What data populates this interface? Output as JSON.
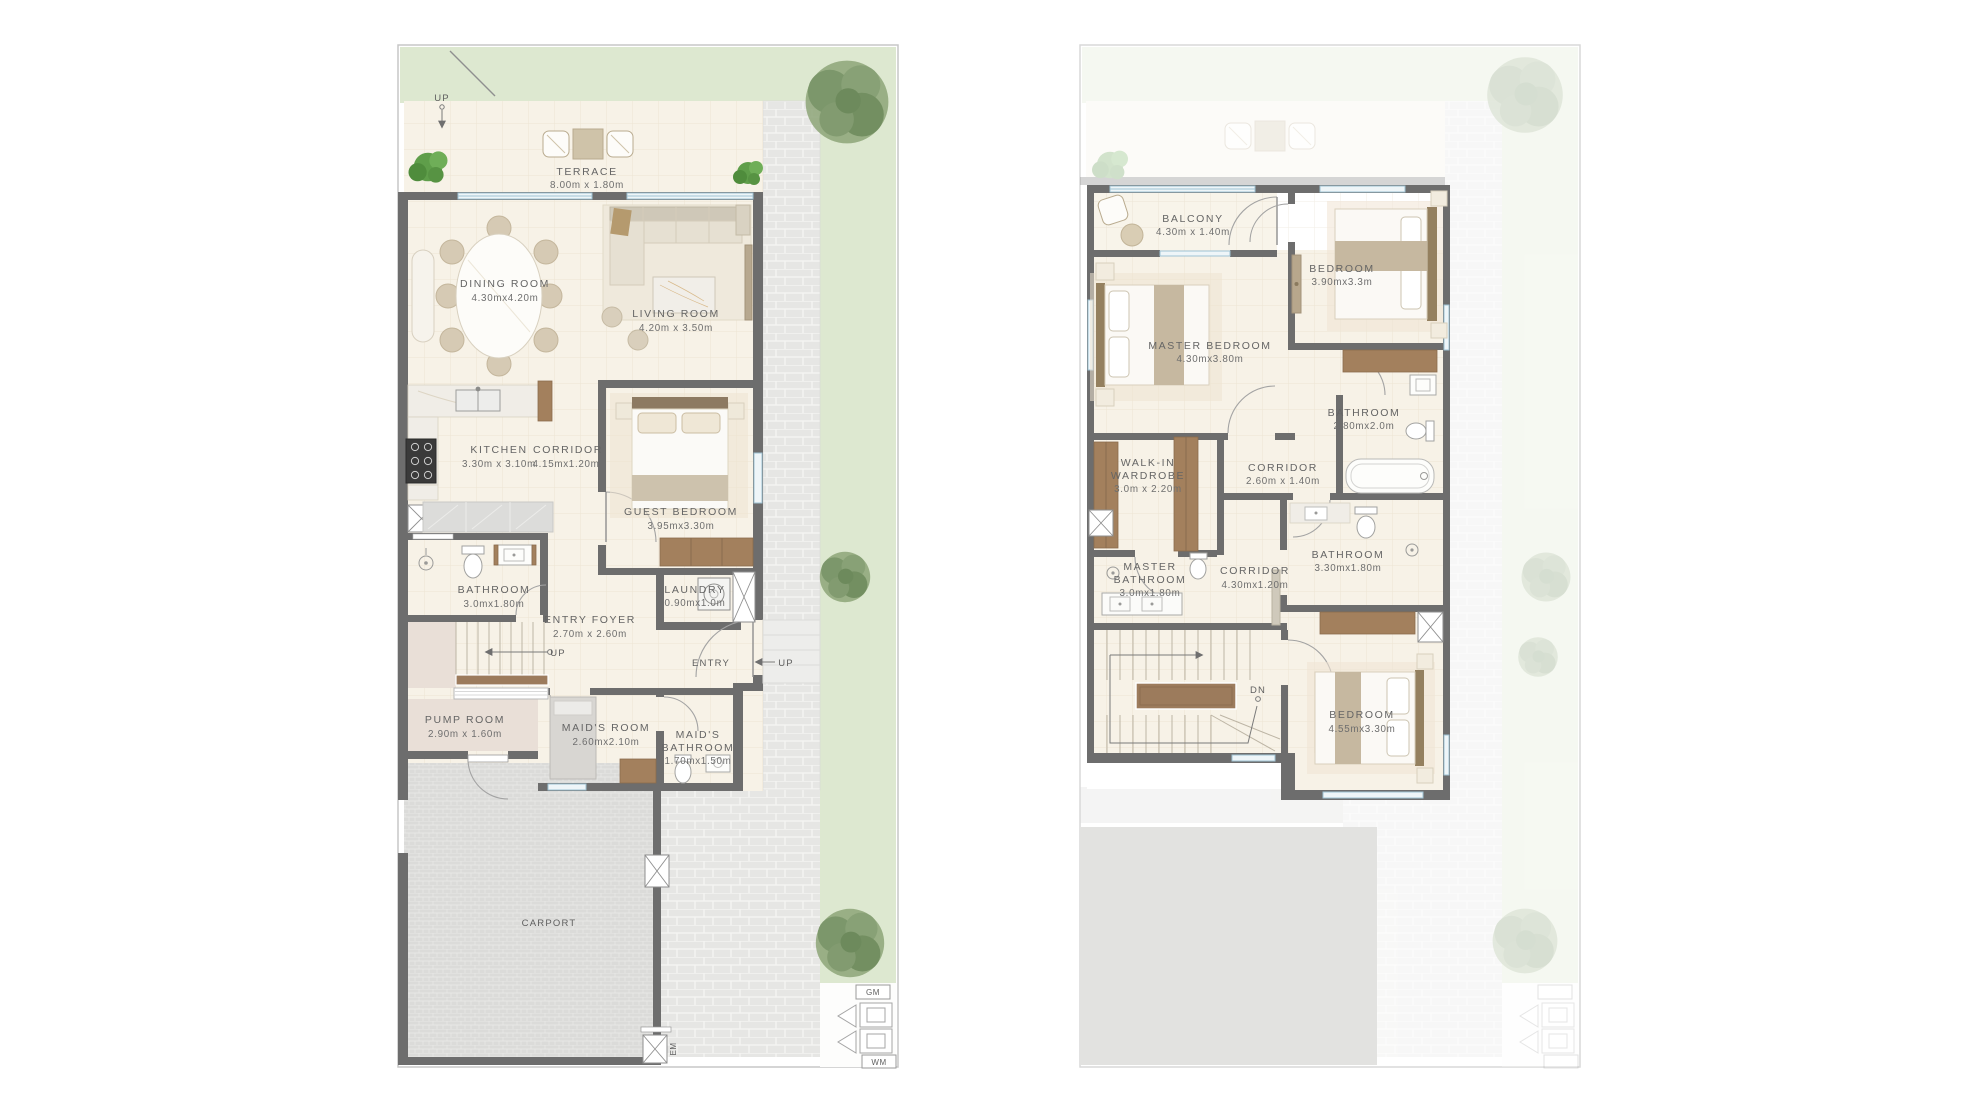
{
  "document": {
    "type": "residential floor plans",
    "views": [
      "ground floor",
      "first floor"
    ]
  },
  "ground_floor": {
    "rooms": [
      {
        "name": "TERRACE",
        "dims": "8.00m x 1.80m"
      },
      {
        "name": "DINING ROOM",
        "dims": "4.30mx4.20m"
      },
      {
        "name": "LIVING ROOM",
        "dims": "4.20m x 3.50m"
      },
      {
        "name": "KITCHEN",
        "dims": "3.30m x 3.10m"
      },
      {
        "name": "CORRIDOR",
        "dims": "4.15mx1.20m"
      },
      {
        "name": "GUEST BEDROOM",
        "dims": "3.95mx3.30m"
      },
      {
        "name": "BATHROOM",
        "dims": "3.0mx1.80m"
      },
      {
        "name": "LAUNDRY",
        "dims": "0.90mx1.0m"
      },
      {
        "name": "ENTRY FOYER",
        "dims": "2.70m x 2.60m"
      },
      {
        "name": "PUMP ROOM",
        "dims": "2.90m x 1.60m"
      },
      {
        "name": "MAID'S ROOM",
        "dims": "2.60mx2.10m"
      },
      {
        "name": "MAID'S",
        "name2": "BATHROOM",
        "dims": "1.70mx1.50m"
      }
    ],
    "annotations": {
      "up_garden": "UP",
      "up_stairs": "UP",
      "entry": "ENTRY",
      "up_entry": "UP",
      "carport": "CARPORT",
      "em": "EM",
      "gm": "GM",
      "wm": "WM"
    }
  },
  "first_floor": {
    "rooms": [
      {
        "name": "BALCONY",
        "dims": "4.30m x 1.40m"
      },
      {
        "name": "MASTER BEDROOM",
        "dims": "4.30mx3.80m"
      },
      {
        "name": "BEDROOM",
        "dims": "3.90mx3.3m"
      },
      {
        "name": "BATHROOM",
        "dims": "2.80mx2.0m"
      },
      {
        "name": "WALK-IN",
        "name2": "WARDROBE",
        "dims": "3.0m x 2.20m"
      },
      {
        "name": "CORRIDOR",
        "dims": "2.60m x 1.40m"
      },
      {
        "name": "MASTER",
        "name2": "BATHROOM",
        "dims": "3.0mx1.80m"
      },
      {
        "name": "CORRIDOR",
        "dims": "4.30mx1.20m"
      },
      {
        "name": "BATHROOM",
        "dims": "3.30mx1.80m"
      },
      {
        "name": "BEDROOM",
        "dims": "4.55mx3.30m"
      }
    ],
    "annotations": {
      "dn": "DN"
    }
  },
  "colors": {
    "wall": "#6d6d6d",
    "floor": "#f7f2e7",
    "lawn": "#dde8d0",
    "paving": "#e6e6e4",
    "carport": "#dbdbd9",
    "service_room": "#e9dfd7",
    "wood": "#a3805d",
    "glazing": "#9fc2d4"
  }
}
